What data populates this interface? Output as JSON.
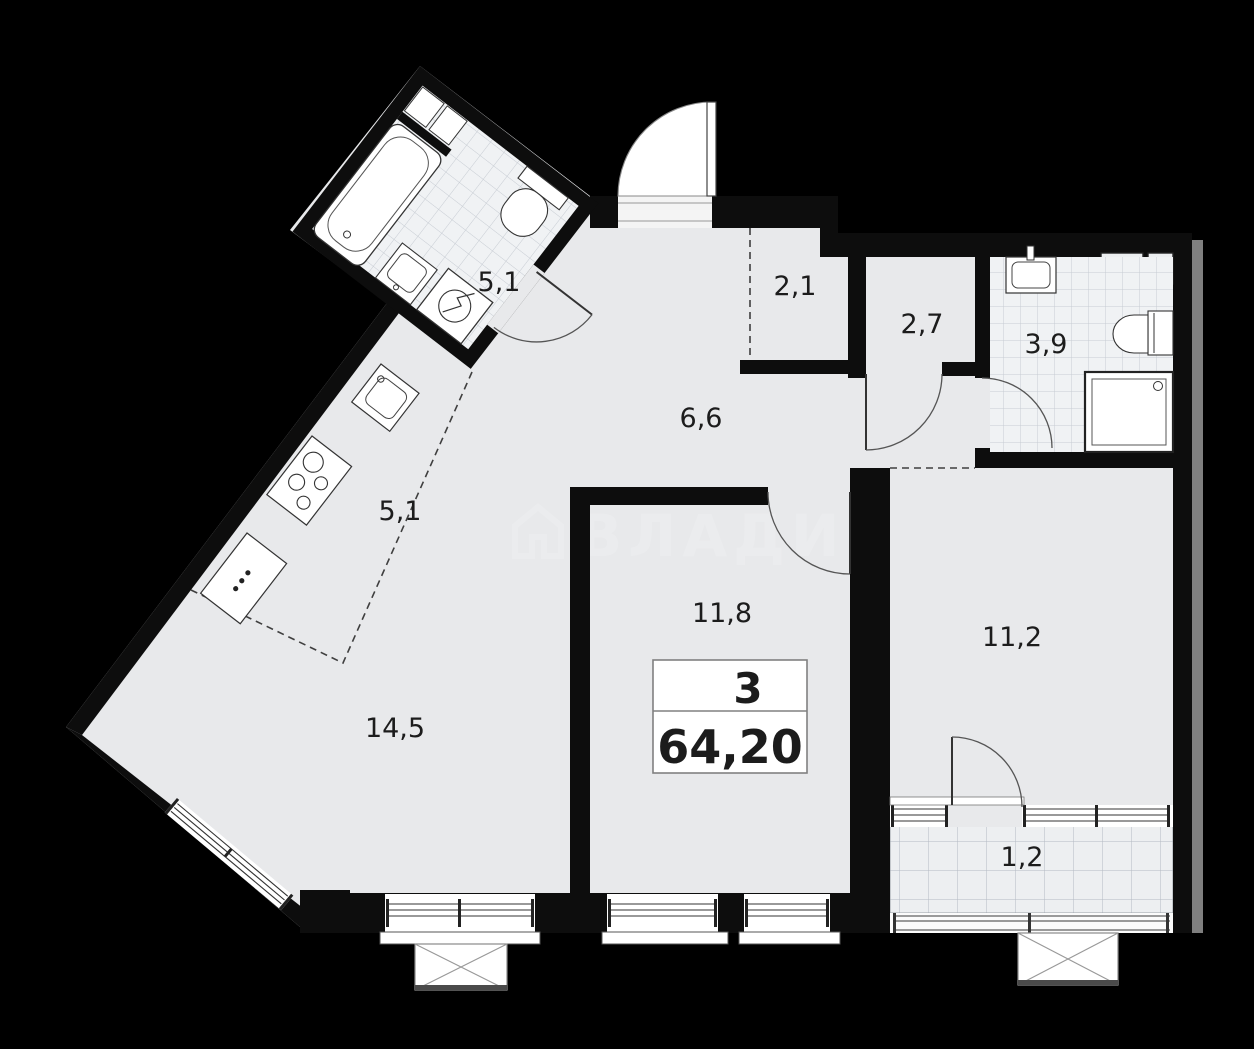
{
  "plan": {
    "unit_box": {
      "rooms_count": "3",
      "total_area": "64,20"
    },
    "watermark_text": "ВЛАДИС",
    "rooms": {
      "bathroom_combined": {
        "label": "5,1"
      },
      "kitchen": {
        "label": "5,1"
      },
      "hallway": {
        "label": "6,6"
      },
      "wardrobe": {
        "label": "2,1"
      },
      "corridor": {
        "label": "2,7"
      },
      "bathroom": {
        "label": "3,9"
      },
      "bedroom": {
        "label": "11,8"
      },
      "bedroom2": {
        "label": "11,2"
      },
      "living_room": {
        "label": "14,5"
      },
      "balcony": {
        "label": "1,2"
      }
    },
    "colors": {
      "background": "#000000",
      "floor": "#e8e9eb",
      "wall": "#0d0d0d",
      "tile_floor": "#f0f2f4",
      "shadow": "#7f7f7f"
    }
  }
}
